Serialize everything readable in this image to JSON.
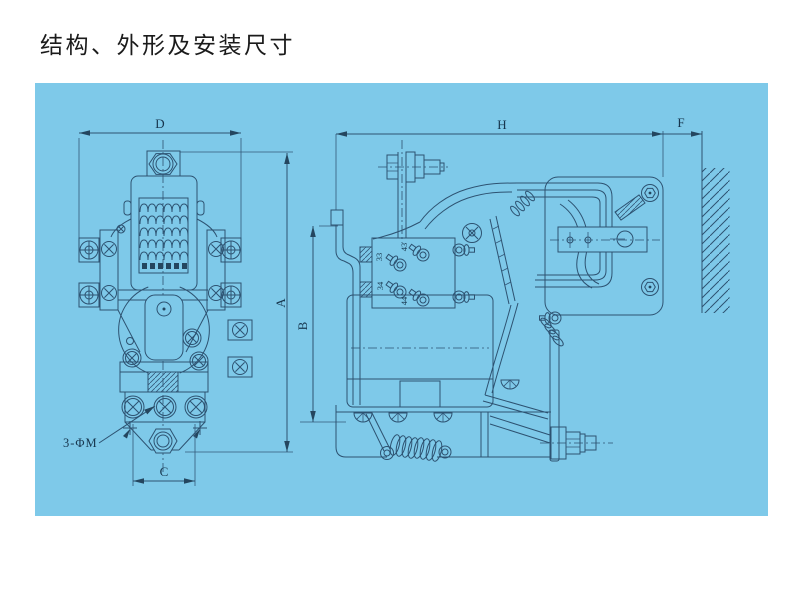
{
  "page": {
    "title": "结构、外形及安装尺寸"
  },
  "figure": {
    "panel_color": "#7ec9e9",
    "line_color": "#2d5271",
    "dims": {
      "D": "D",
      "A": "A",
      "C": "C",
      "B": "B",
      "H": "H",
      "F": "F"
    },
    "mounting_note": "3-ΦM",
    "aux_terminals": {
      "t43": "43",
      "t33": "33",
      "t34": "34",
      "t44": "44"
    }
  }
}
